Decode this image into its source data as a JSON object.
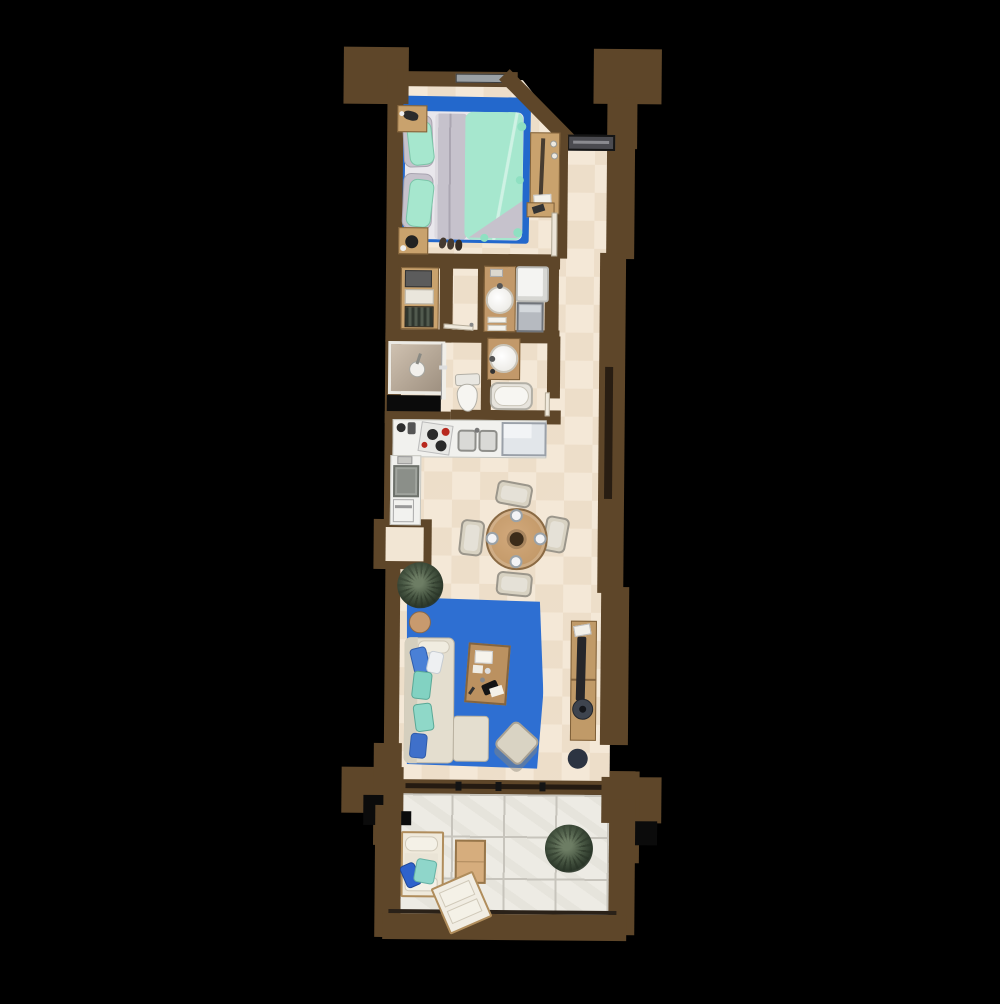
{
  "scene": {
    "type": "floor-plan",
    "view": "top-down",
    "unit_shape": "long-narrow-apartment",
    "rooms": [
      {
        "name": "bedroom",
        "objects": [
          "double-bed",
          "mint-duvet",
          "gray-blanket",
          "pillows",
          "blue-area-rug",
          "nightstand-left-top",
          "nightstand-left-bottom",
          "slippers",
          "dresser-mirror-unit",
          "wall-shelf",
          "top-window"
        ]
      },
      {
        "name": "entry-hall",
        "objects": [
          "entry-door",
          "diagonal-wall"
        ]
      },
      {
        "name": "closet",
        "objects": [
          "wardrobe-top-box",
          "wardrobe-shelf-box",
          "hanging-clothes"
        ]
      },
      {
        "name": "shower-room",
        "objects": [
          "walk-in-shower",
          "shower-head",
          "glass-door",
          "service-shaft"
        ]
      },
      {
        "name": "bathroom-upper",
        "objects": [
          "wood-vanity",
          "round-sink",
          "towels",
          "shower-cabin",
          "washing-machine"
        ]
      },
      {
        "name": "wc",
        "objects": [
          "toilet",
          "open-door"
        ]
      },
      {
        "name": "bathroom-lower",
        "objects": [
          "wood-vanity",
          "round-sink",
          "bathtub",
          "open-door"
        ]
      },
      {
        "name": "kitchen",
        "objects": [
          "counter-run",
          "cooktop-red-knobs",
          "double-sink",
          "refrigerator",
          "cooktop-square",
          "oven",
          "coffee-machine",
          "wall-niche"
        ]
      },
      {
        "name": "dining-area",
        "objects": [
          "round-wood-table",
          "chair-north",
          "chair-south",
          "chair-east",
          "chair-west",
          "four-place-settings",
          "centerpiece",
          "potted-palm"
        ]
      },
      {
        "name": "living-room",
        "objects": [
          "blue-area-rug",
          "l-shaped-sofa",
          "sofa-pillows",
          "round-side-table",
          "work-desk",
          "papers",
          "black-laptop",
          "ottoman",
          "tv-console",
          "flat-tv",
          "speaker",
          "dark-pouf"
        ]
      },
      {
        "name": "terrace",
        "objects": [
          "sliding-glass-door",
          "stone-tile-floor",
          "outdoor-bench",
          "bench-pillows",
          "outdoor-wood-table",
          "sun-lounger",
          "potted-palm",
          "wall-columns"
        ]
      }
    ]
  },
  "palette": {
    "wall": "#5e4629",
    "floor": "#f4e8d7",
    "terrace": "#edebe4",
    "grout": "#c7c4bc",
    "rug": "#2368cc",
    "rug2": "#2e6fd2",
    "mint": "#a6e7ce",
    "grayfab": "#c6c2cc",
    "wood": "#c9a26d",
    "wood-dark": "#7e5f38",
    "sofa": "#e4decf",
    "chair": "#d8d2c2",
    "pil-blue": "#3f70ca",
    "pil-teal": "#8fd8c8",
    "plant": "#495844",
    "fixture": "#f4f3ef",
    "appliance": "#b6bac0",
    "door": "#4b4b50",
    "tv": "#26262a",
    "shaft": "#0b0b0b"
  }
}
